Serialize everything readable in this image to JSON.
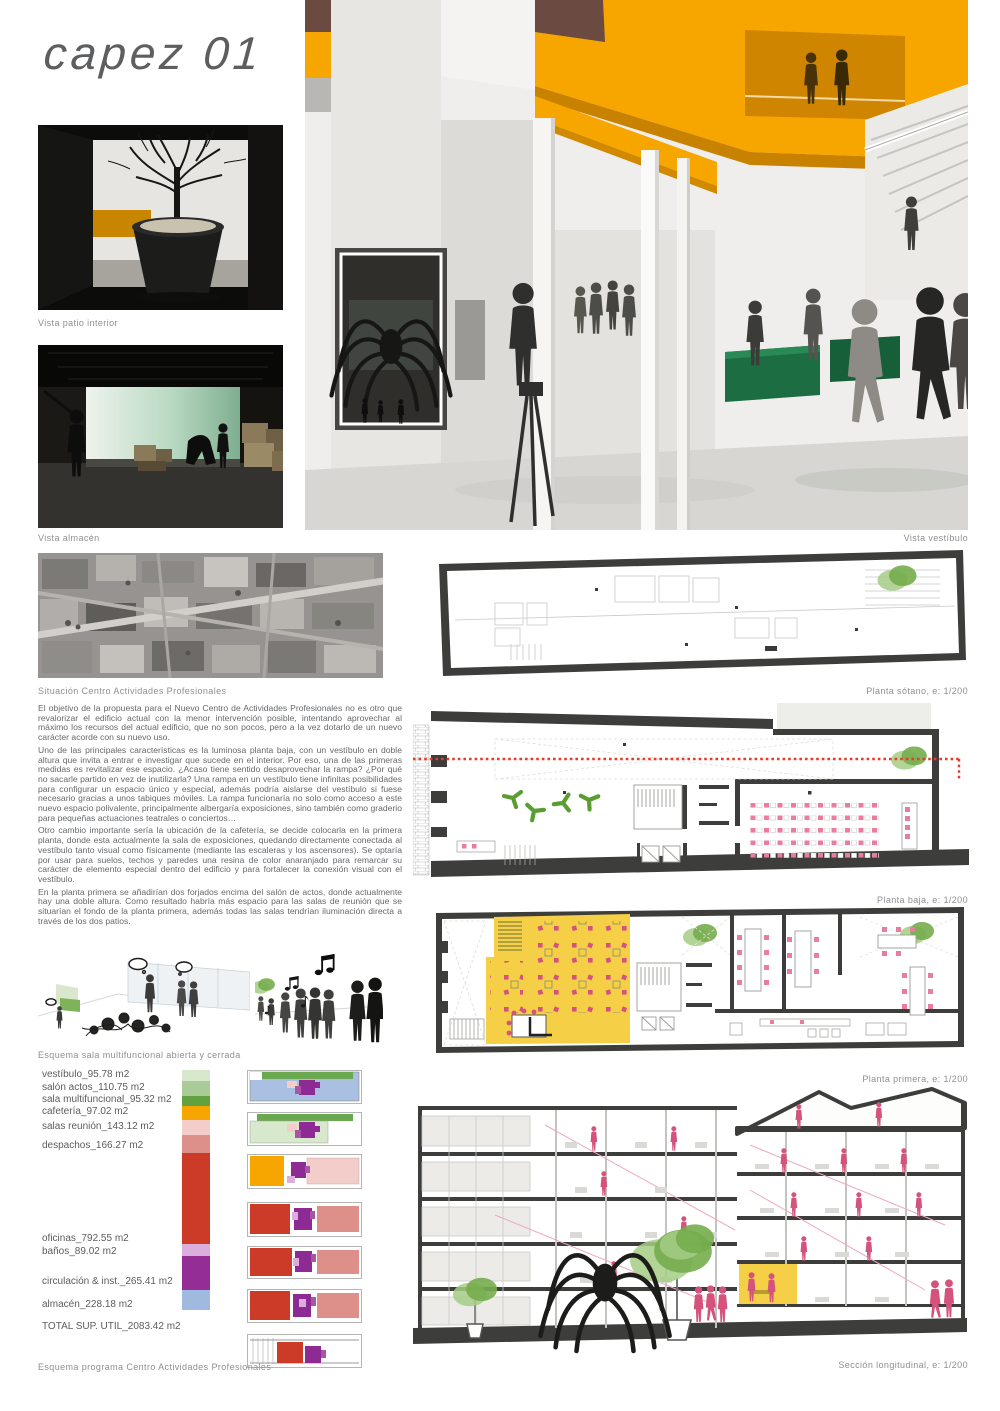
{
  "page": {
    "title": "capez 01"
  },
  "captions": {
    "patio": "Vista patio interior",
    "almacen": "Vista almacén",
    "vestibulo": "Vista vestíbulo",
    "situacion": "Situación Centro Actividades Profesionales",
    "sotano": "Planta sótano, e: 1/200",
    "baja": "Planta baja, e: 1/200",
    "primera": "Planta primera, e: 1/200",
    "seccion": "Sección longitudinal, e: 1/200",
    "esquema_sala": "Esquema sala multifuncional abierta y cerrada",
    "esquema_programa": "Esquema programa Centro Actividades Profesionales"
  },
  "main_text": {
    "paragraphs": [
      "El objetivo de la propuesta para el Nuevo Centro de Actividades Profesionales no es otro que revalorizar el edificio actual con la menor intervención posible, intentando aprovechar al máximo los recursos del actual edificio, que no son pocos, pero a la vez dotarlo de un nuevo carácter acorde con su nuevo uso.",
      "Uno de las principales características es la luminosa planta baja, con un vestíbulo en doble altura que invita a entrar e investigar que sucede en el interior. Por eso, una de las primeras medidas es revitalizar ese espacio. ¿Acaso tiene sentido desaprovechar la rampa? ¿Por qué no sacarle partido en vez de inutilizarla? Una rampa en un vestíbulo tiene infinitas posibilidades para configurar un espacio único y especial, además podría aislarse del vestíbulo si fuese necesario gracias a unos tabiques móviles. La rampa funcionaría no solo como acceso a este nuevo espacio polivalente, principalmente albergaría exposiciones, sino también como graderio para pequeñas actuaciones teatrales o conciertos…",
      "Otro cambio importante sería la ubicación de la cafetería, se decide colocarla en la primera planta, donde esta actualmente la sala de exposiciones, quedando directamente conectada al vestíbulo tanto visual como físicamente (mediante las escaleras y los ascensores). Se optaría por usar para suelos, techos y paredes una resina de color anaranjado para remarcar su carácter de elemento especial dentro del edificio y para fortalecer la conexión visual con el vestíbulo.",
      "En la planta primera se añadirían dos forjados encima del salón de actos, donde actualmente hay una doble altura. Como resultado habría más espacio para las salas de reunión que se situarían el fondo de la planta primera, además todas las salas tendrían iluminación directa a través de los dos patios."
    ]
  },
  "legend": {
    "items": [
      {
        "label": "vestíbulo_95.78 m2",
        "color": "#d7e8cd"
      },
      {
        "label": "salón actos_110.75 m2",
        "color": "#a9cb97"
      },
      {
        "label": "sala multifuncional_95.32 m2",
        "color": "#61a140"
      },
      {
        "label": "cafetería_97.02 m2",
        "color": "#f7a600"
      },
      {
        "label": "salas reunión_143.12 m2",
        "color": "#f3cdca"
      },
      {
        "label": "despachos_166.27 m2",
        "color": "#dd9089"
      },
      {
        "label": "oficinas_792.55 m2",
        "color": "#cc3b28"
      },
      {
        "label": "baños_89.02 m2",
        "color": "#dcaedd"
      },
      {
        "label": "circulación & inst._265.41 m2",
        "color": "#952d96"
      },
      {
        "label": "almacén_228.18 m2",
        "color": "#a0b9de"
      }
    ],
    "total_label": "TOTAL SUP. UTIL_2083.42 m2"
  },
  "palette": {
    "accent_orange": "#f7a600",
    "wall_dark": "#3d3d3b",
    "plan_pink": "#e87da0",
    "chair_pink": "#d4527c",
    "furniture_green": "#5a9e32",
    "tree_green": "#8cbf63",
    "zone_yellow": "#f5cf45",
    "section_line_red": "#e8392a"
  }
}
